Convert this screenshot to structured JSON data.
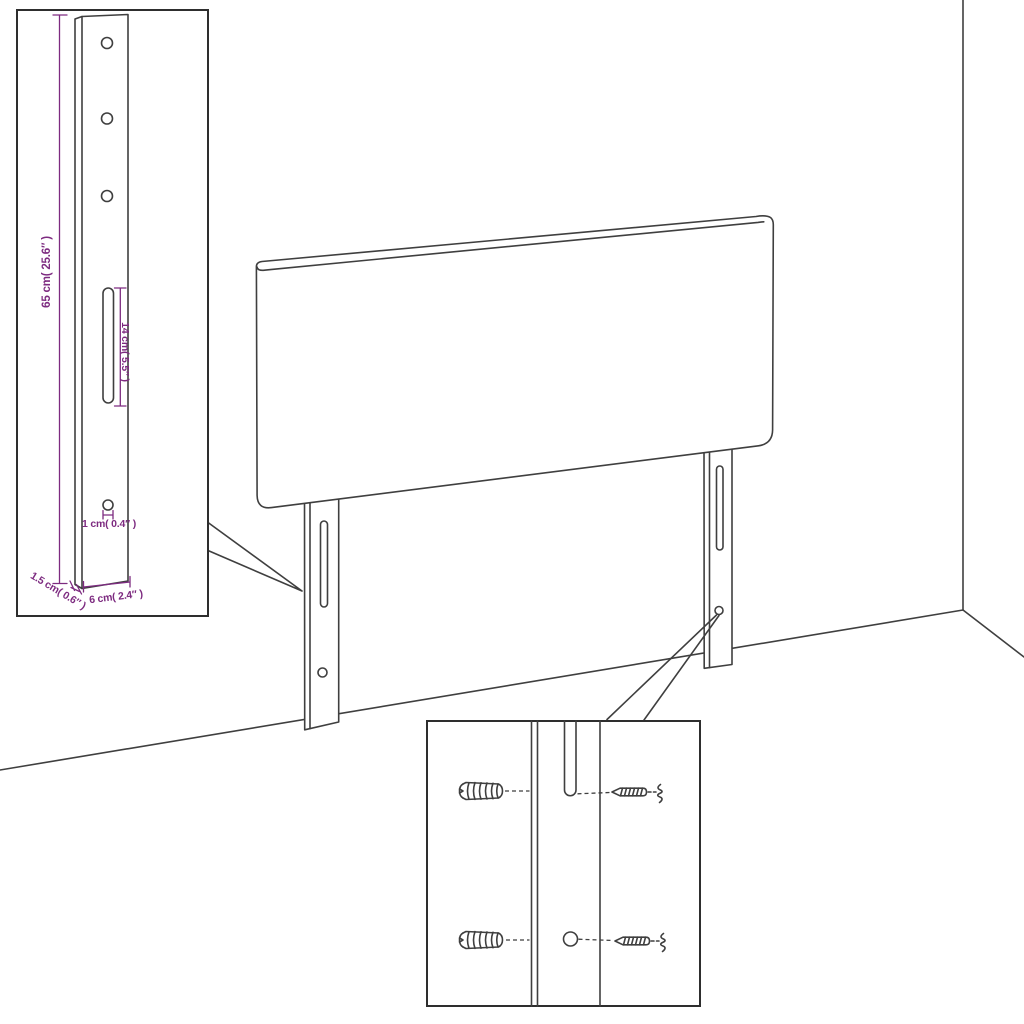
{
  "colors": {
    "line": "#3f3f3f",
    "dimension": "#7d2b80",
    "background": "#ffffff"
  },
  "dimensions": {
    "height": "65 cm( 25.6″ )",
    "slot_length": "14 cm( 5.5″ )",
    "hole": "1 cm( 0.4″ )",
    "width": "6 cm( 2.4″ )",
    "thickness": "1.5 cm( 0.6″ )"
  },
  "icons": {
    "wall_plug": "wall-plug-icon",
    "screw": "screw-icon",
    "screw_hole": "screw-hole-icon",
    "slot": "slot-icon"
  }
}
